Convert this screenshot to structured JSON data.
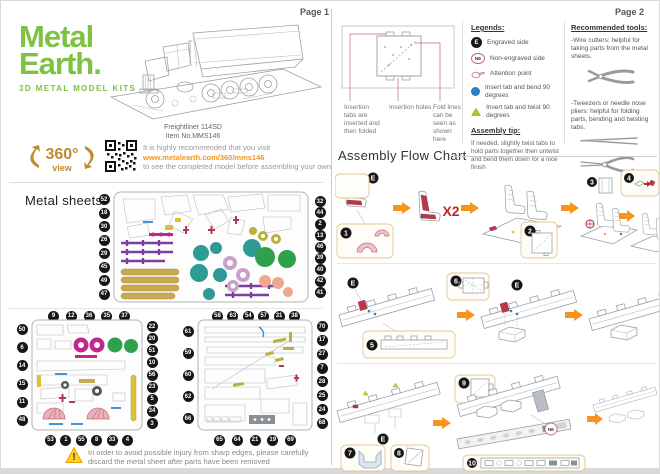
{
  "page1": {
    "page_label": "Page 1",
    "logo": {
      "word1": "Metal",
      "word2": "Earth.",
      "tagline": "3D METAL MODEL KITS"
    },
    "product": {
      "name": "Freightliner 114SD",
      "item_no": "Item No.MMS146"
    },
    "badge360": {
      "number": "360°",
      "view": "view"
    },
    "recommend": {
      "line1": "It is highly recommended that you visit",
      "url": "www.metalearth.com/360/mms146",
      "line2": "to see the completed model before assembling your own"
    },
    "metal_sheets": {
      "title": "Metal sheets",
      "sheet1": {
        "left": [
          52,
          18,
          30,
          26,
          29,
          45,
          49,
          47
        ],
        "right": [
          32,
          44,
          2,
          13,
          46,
          39,
          40,
          42,
          41
        ]
      },
      "sheet2": {
        "top": [
          9,
          12,
          36,
          35,
          37
        ],
        "left": [
          50,
          6,
          14,
          15,
          11,
          48
        ],
        "right": [
          22,
          20,
          51,
          10,
          56,
          23,
          5,
          34,
          3
        ],
        "bottom": [
          53,
          1,
          55,
          8,
          33,
          4
        ]
      },
      "sheet3": {
        "top": [
          58,
          63,
          54,
          57,
          31,
          38
        ],
        "left": [
          61,
          59,
          60,
          62,
          66
        ],
        "right": [
          70,
          17,
          27,
          7,
          28,
          25,
          24,
          68
        ],
        "bottom": [
          65,
          64,
          21,
          19,
          69
        ]
      }
    },
    "warning": {
      "mark": "!",
      "line1": "In order to avoid possible injury from sharp edges, please carefully",
      "line2": "discard the metal sheet after parts have been removed"
    }
  },
  "page2": {
    "page_label": "Page 2",
    "insertion": {
      "tabs_label": "Insertion tabs are inserted and then folded",
      "holes_label": "Insertion holes",
      "fold_label": "Fold lines can be seen as shown here"
    },
    "legends": {
      "title": "Legends:",
      "engraved": {
        "symbol": "E",
        "label": "Engraved side"
      },
      "non_engraved": {
        "symbol": "NE",
        "label": "Non-engraved side"
      },
      "attention": {
        "label": "Attention point"
      },
      "bend": {
        "label": "Insert tab and bend 90 degrees"
      },
      "twist": {
        "label": "Insert tab and twist 90 degrees"
      }
    },
    "assembly_tip": {
      "title": "Assembly tip:",
      "text": "If needed, slightly twist tabs to hold parts together then untwist and bend them down for a nice finish"
    },
    "tools": {
      "title": "Recommended tools:",
      "wire_cutters": "-Wire cutters: helpful for taking parts from the metal sheets.",
      "tweezers": "-Tweezers or needle nose pliers: helpful for folding parts, bending and twisting tabs."
    },
    "flow": {
      "title": "Assembly Flow Chart",
      "x2": "X2",
      "steps": [
        "1",
        "2",
        "3",
        "4",
        "5",
        "6",
        "7",
        "8",
        "9",
        "10"
      ]
    }
  },
  "colors": {
    "brand_green": "#7DC242",
    "accent_orange": "#F7941D",
    "flow_red": "#C1272D",
    "legend_blue": "#2E7FC1",
    "legend_triangle": "#B8C42E",
    "badge_black": "#161616",
    "gold": "#C08A2D"
  }
}
